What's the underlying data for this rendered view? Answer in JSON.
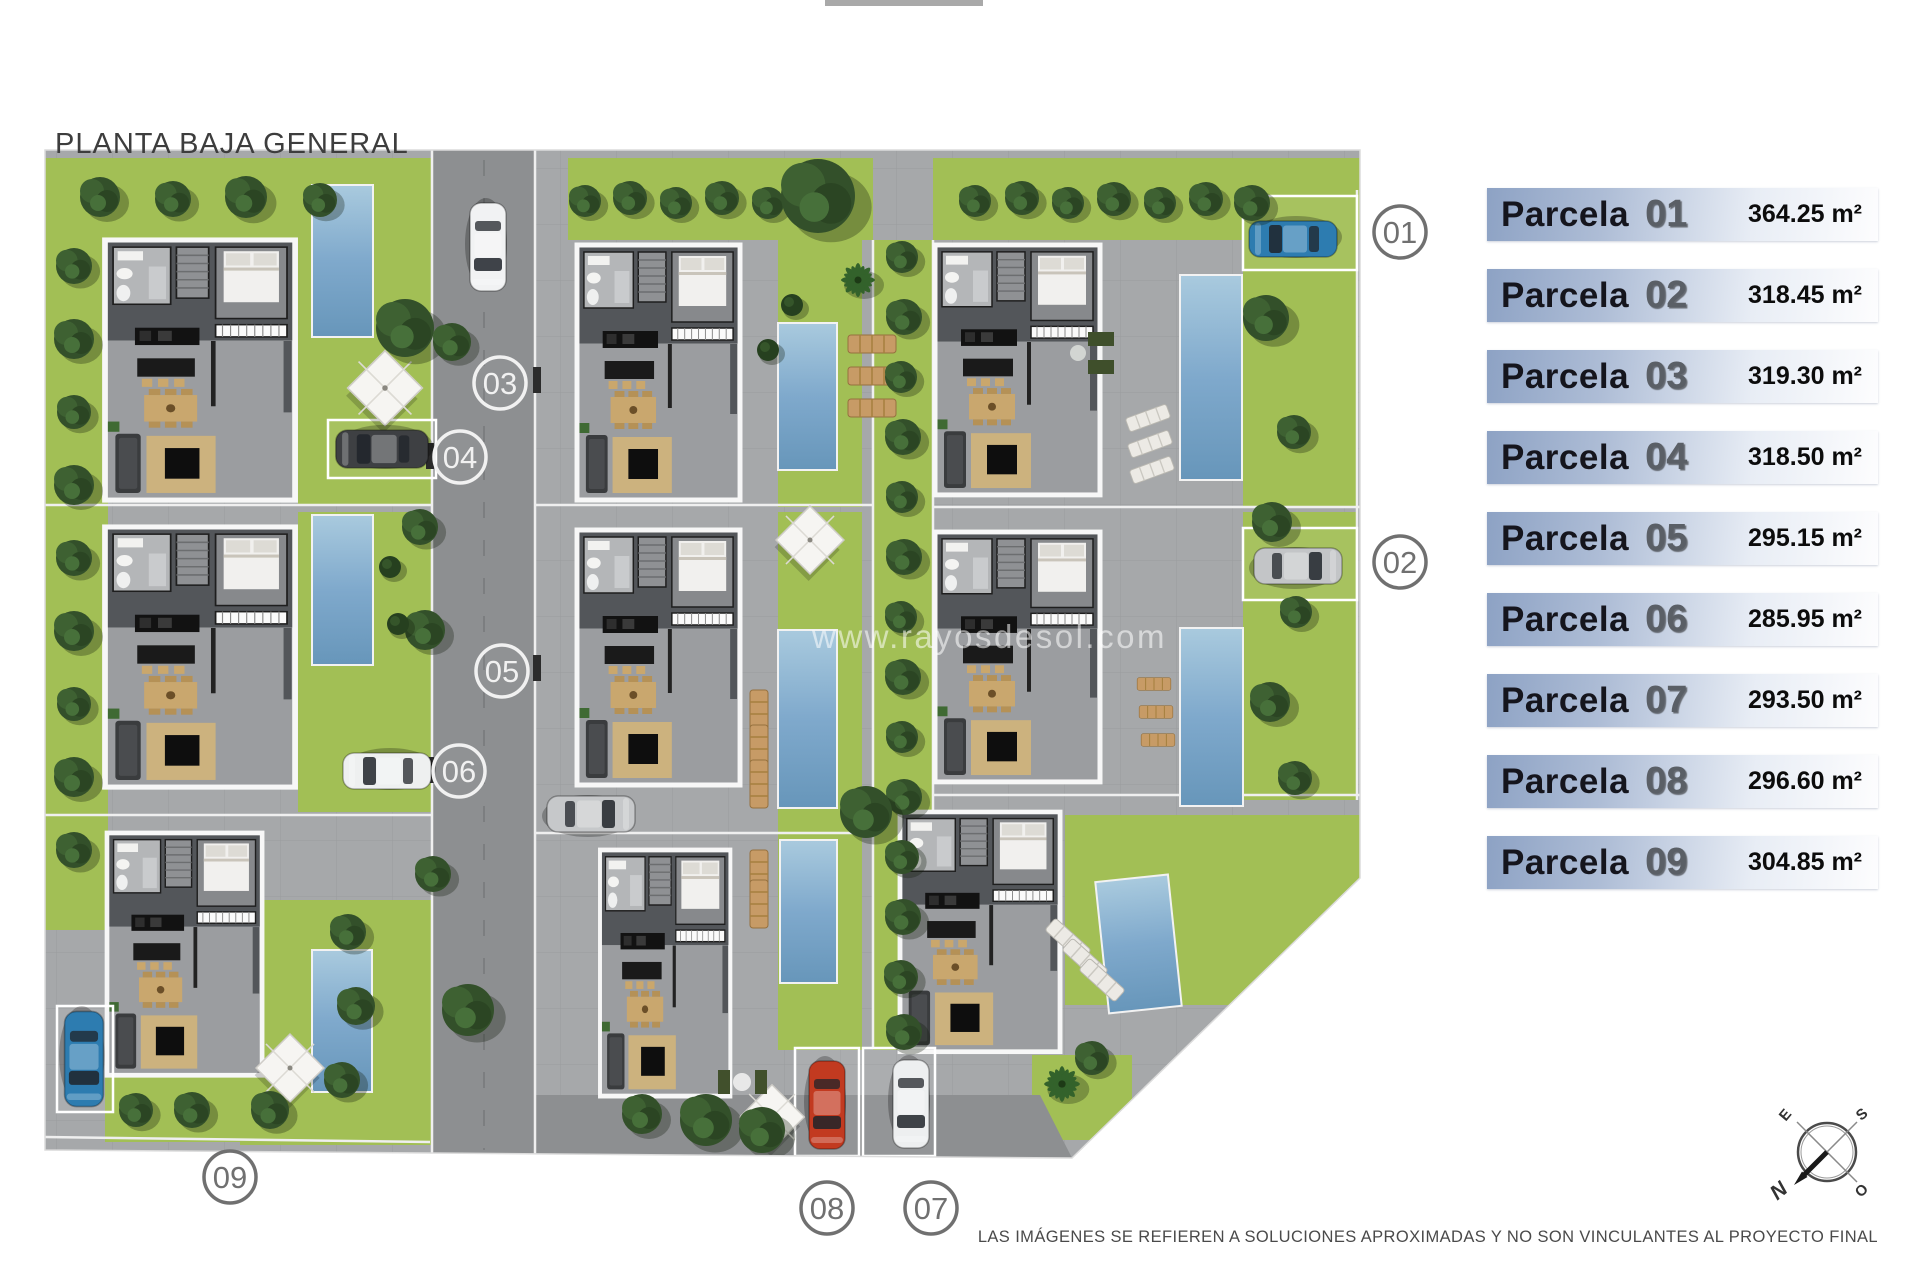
{
  "page": {
    "title": "PLANTA BAJA GENERAL",
    "watermark": "www.rayosdesol.com",
    "disclaimer": "LAS IMÁGENES SE REFIEREN A SOLUCIONES APROXIMADAS Y NO SON VINCULANTES AL PROYECTO FINAL"
  },
  "legend": {
    "rows": [
      {
        "label": "Parcela",
        "number": "01",
        "area": "364.25 m²"
      },
      {
        "label": "Parcela",
        "number": "02",
        "area": "318.45 m²"
      },
      {
        "label": "Parcela",
        "number": "03",
        "area": "319.30 m²"
      },
      {
        "label": "Parcela",
        "number": "04",
        "area": "318.50 m²"
      },
      {
        "label": "Parcela",
        "number": "05",
        "area": "295.15 m²"
      },
      {
        "label": "Parcela",
        "number": "06",
        "area": "285.95 m²"
      },
      {
        "label": "Parcela",
        "number": "07",
        "area": "293.50 m²"
      },
      {
        "label": "Parcela",
        "number": "08",
        "area": "296.60 m²"
      },
      {
        "label": "Parcela",
        "number": "09",
        "area": "304.85 m²"
      }
    ]
  },
  "plan": {
    "markers": [
      {
        "id": "01"
      },
      {
        "id": "02"
      },
      {
        "id": "03"
      },
      {
        "id": "04"
      },
      {
        "id": "05"
      },
      {
        "id": "06"
      },
      {
        "id": "07"
      },
      {
        "id": "08"
      },
      {
        "id": "09"
      }
    ]
  },
  "compass": {
    "n": "N",
    "s": "S",
    "e": "E",
    "o": "O"
  },
  "colors": {
    "legend_blue": "#8da2c4",
    "lawn_green": "#a2bf55",
    "pool_blue": "#7fa9cc",
    "paving_gray": "#a6a8aa",
    "road_gray": "#8d8f91"
  }
}
